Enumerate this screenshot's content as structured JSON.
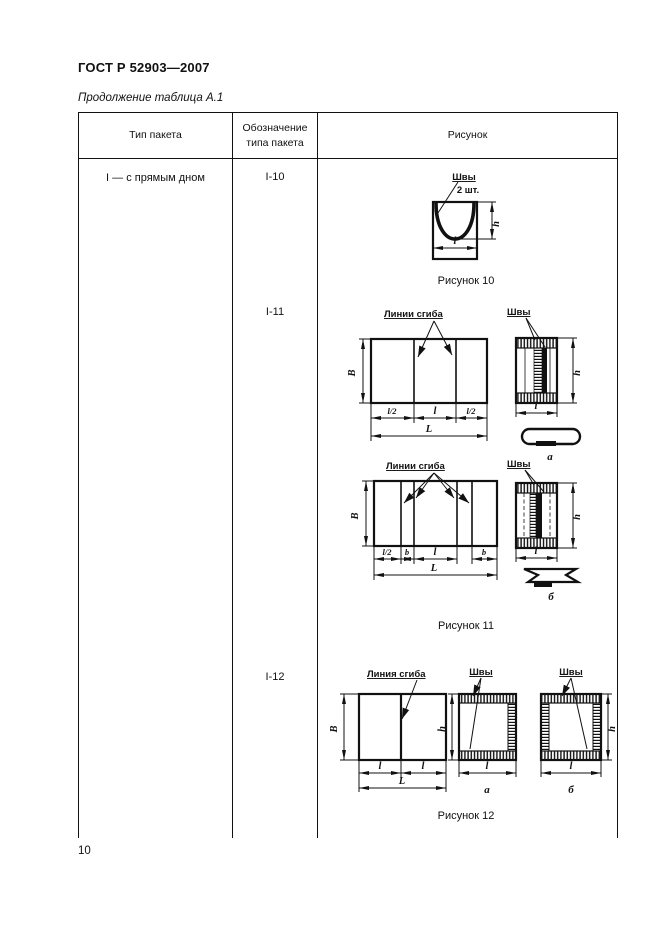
{
  "page": {
    "doc_number": "ГОСТ Р 52903—2007",
    "continuation_caption": "Продолжение таблица А.1",
    "page_number": "10"
  },
  "table": {
    "headers": {
      "type": "Тип пакета",
      "designation": "Обозначение типа пакета",
      "figure": "Рисунок"
    },
    "package_type": "I — с прямым дном",
    "designations": [
      "I-10",
      "I-11",
      "I-12"
    ]
  },
  "fig10": {
    "caption": "Рисунок 10",
    "seams_label": "Швы",
    "seams_qty": "2 шт.",
    "dims": {
      "h": "h",
      "l": "l"
    }
  },
  "fig11": {
    "caption": "Рисунок 11",
    "fold_lines_label": "Линии сгиба",
    "seams_label": "Швы",
    "variant_a": "а",
    "variant_b": "б",
    "dims": {
      "B": "В",
      "L": "L",
      "l": "l",
      "half_l": "l/2",
      "b": "b",
      "h": "h"
    }
  },
  "fig12": {
    "caption": "Рисунок 12",
    "fold_line_label": "Линия сгиба",
    "seams_label": "Швы",
    "variant_a": "а",
    "variant_b": "б",
    "dims": {
      "B": "В",
      "L": "L",
      "l": "l",
      "h": "h"
    }
  }
}
